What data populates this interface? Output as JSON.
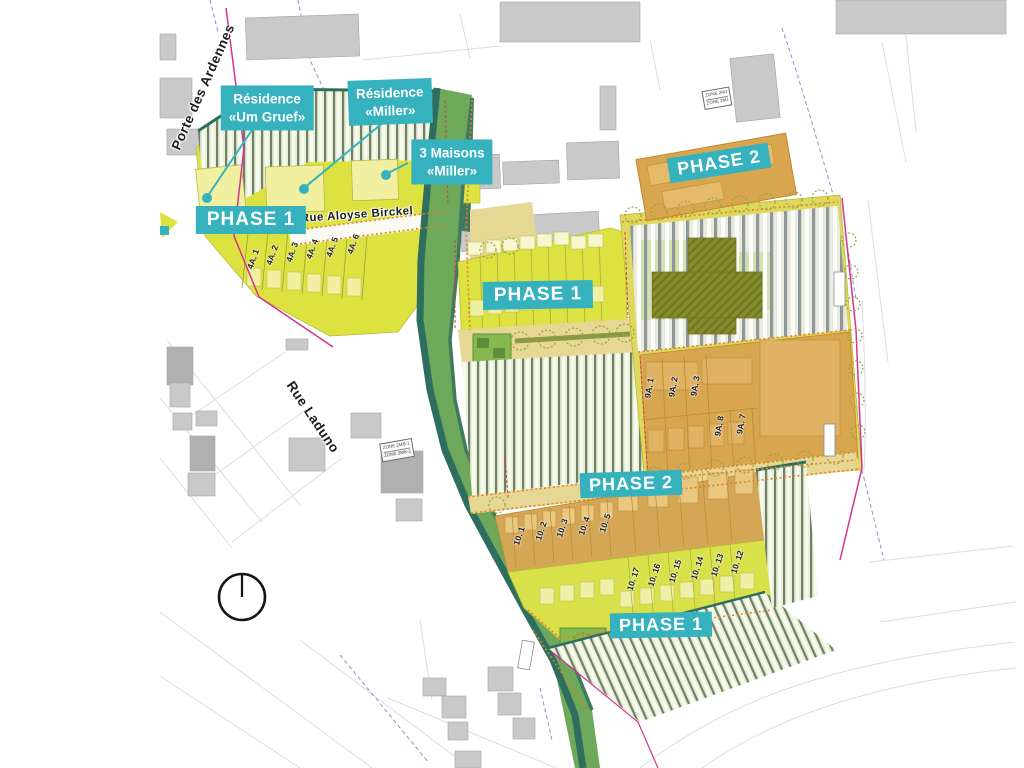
{
  "map_labels": {
    "streets": {
      "porte_des_ardennes": "Porte des Ardennes",
      "rue_aloyse_birckel": "Rue Aloyse Birckel",
      "rue_laduno": "Rue Laduno"
    },
    "phase_badges": {
      "nw_phase1": "PHASE 1",
      "center_phase1": "PHASE 1",
      "south_phase1": "PHASE 1",
      "ne_phase2": "PHASE 2",
      "center_phase2": "PHASE 2"
    },
    "callouts": {
      "residence_um_gruef": {
        "line1": "Résidence",
        "line2": "«Um Gruef»"
      },
      "residence_miller": {
        "line1": "Résidence",
        "line2": "«Miller»"
      },
      "maisons_miller": {
        "line1": "3 Maisons",
        "line2": "«Miller»"
      }
    },
    "lot_numbers": {
      "block_4a": [
        "4A. 1",
        "4A. 2",
        "4A. 3",
        "4A. 4",
        "4A. 5",
        "4A. 6"
      ],
      "block_9a": [
        "9A. 1",
        "9A. 2",
        "9A. 3",
        "9A. 8",
        "9A. 7"
      ],
      "block_10_upper": [
        "10. 1",
        "10. 2",
        "10. 3",
        "10. 4",
        "10. 5"
      ],
      "block_10_lower": [
        "10. 17",
        "10. 16",
        "10. 15",
        "10. 14",
        "10. 13",
        "10. 12"
      ]
    },
    "zone_markers": {
      "ne_line1": "ZONE 2MJ",
      "ne_line2": "ZONE 2MJ",
      "laduno_line1": "ZONE 2MB-1",
      "laduno_line2": "ZONE 2MB-2"
    }
  },
  "colors": {
    "badge_teal": "#35b2be",
    "phase1_yellow": "#dce23f",
    "phase2_orange": "#d7a64e",
    "path_tan": "#e7d795",
    "ribbon_green": "#6ea85a",
    "hedge_green": "#2e6e5f",
    "building_gray": "#c9c9c9",
    "boundary_pink": "#d5338f"
  }
}
